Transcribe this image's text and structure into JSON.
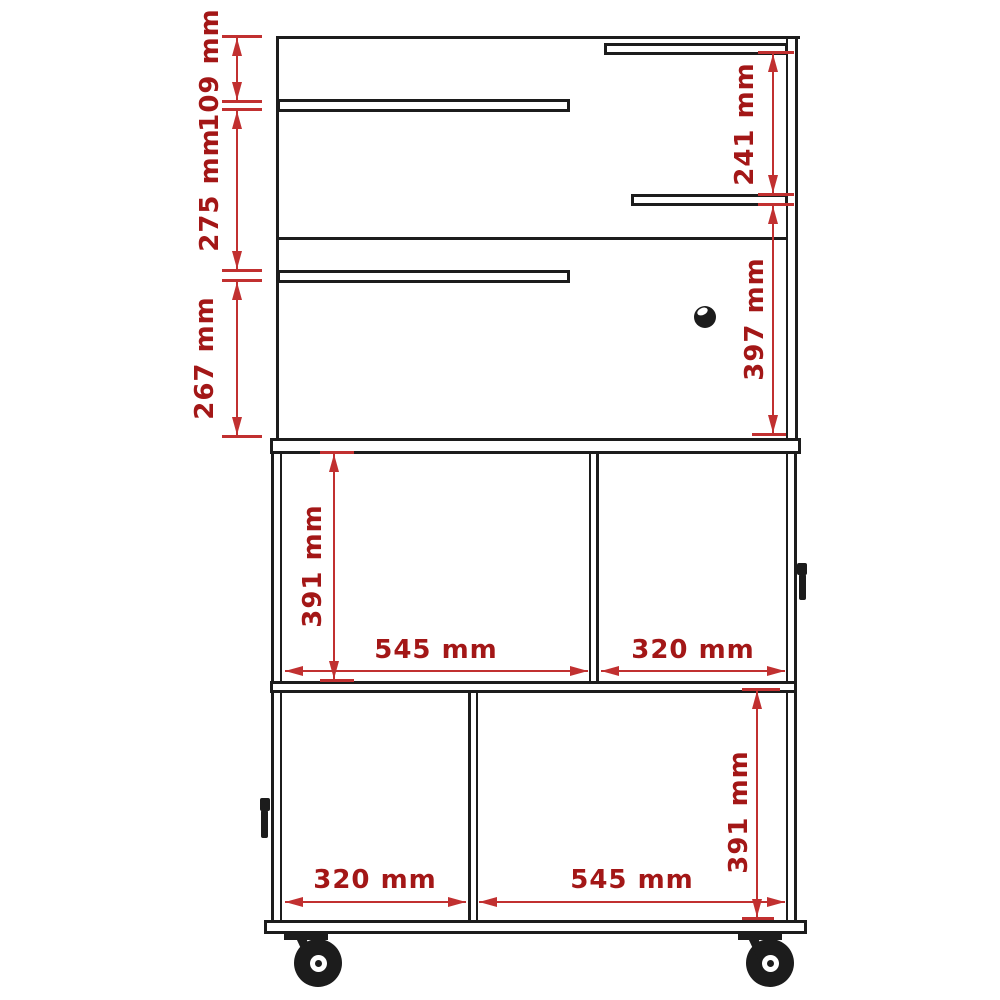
{
  "diagram_title": "cabinet-dimension-drawing",
  "colors": {
    "structure": "#1c1c1c",
    "dim_line": "#c13030",
    "dim_text": "#a31717",
    "background": "#ffffff"
  },
  "labels": {
    "left": [
      "109 mm",
      "275 mm",
      "267 mm"
    ],
    "right": [
      "241 mm",
      "397 mm"
    ],
    "row1_height": "391 mm",
    "row1_cells": [
      "545 mm",
      "320 mm"
    ],
    "row2_cells": [
      "320 mm",
      "545 mm"
    ],
    "row2_height": "391 mm"
  },
  "icons": {
    "keyhole": "keyhole-icon",
    "handle_left": "door-handle-icon",
    "handle_right": "door-handle-icon",
    "caster_left": "caster-wheel-icon",
    "caster_right": "caster-wheel-icon"
  }
}
